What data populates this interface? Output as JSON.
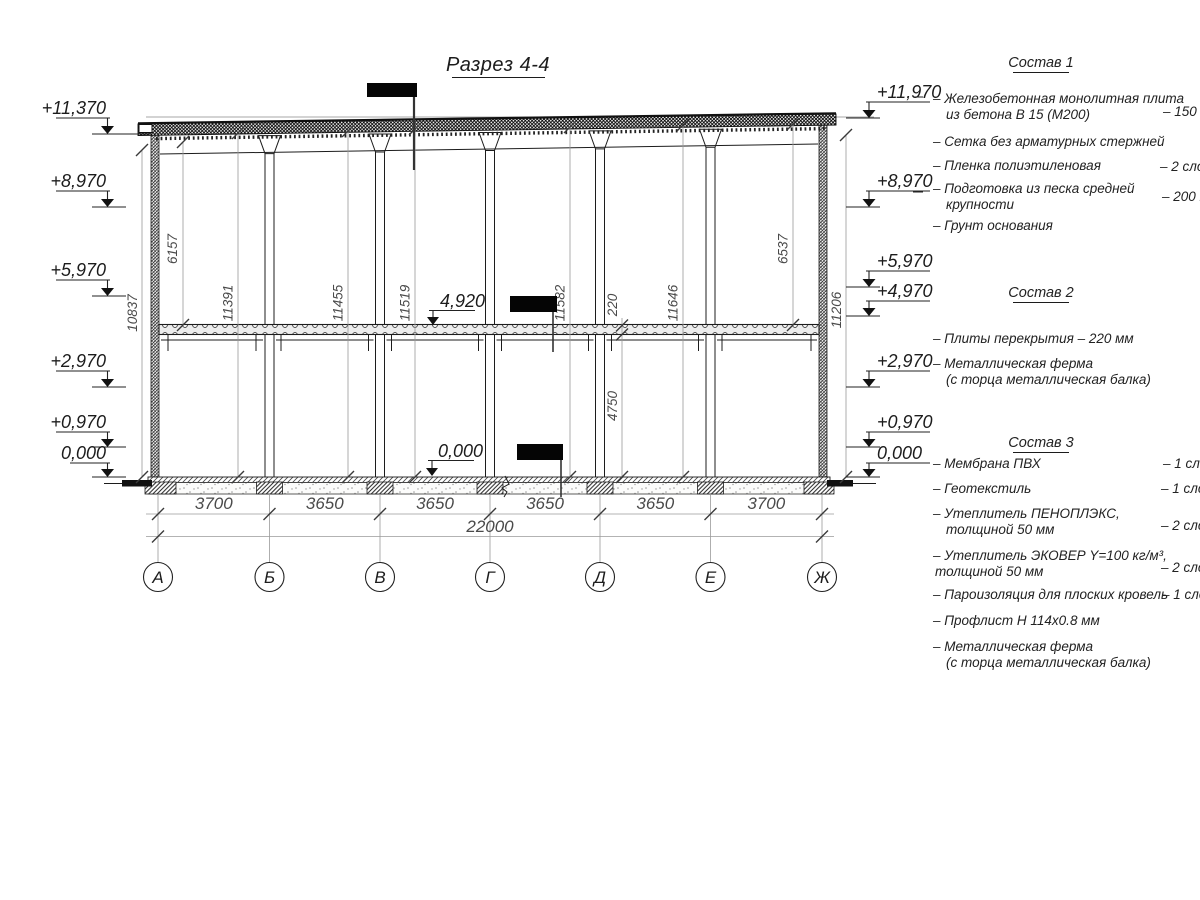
{
  "title": "Разрез 4-4",
  "axes": {
    "labels": [
      "А",
      "Б",
      "В",
      "Г",
      "Д",
      "Е",
      "Ж"
    ]
  },
  "dimensions": {
    "spans": [
      "3700",
      "3650",
      "3650",
      "3650",
      "3650",
      "3700"
    ],
    "total": "22000",
    "vertical": {
      "outer_left": "10837",
      "upper_left": "6157",
      "h1": "11391",
      "h2": "11455",
      "h3": "11519",
      "h4": "11582",
      "slab_thickness": "220",
      "h5": "11646",
      "lower_mid": "4750",
      "upper_right": "6537",
      "outer_right": "11206"
    }
  },
  "elevation_marks": {
    "left": [
      "+11,370",
      "+8,970",
      "+5,970",
      "+2,970",
      "+0,970",
      "0,000"
    ],
    "right": [
      "+11,970",
      "+8,970",
      "+5,970",
      "+4,970",
      "+2,970",
      "+0,970",
      "0,000"
    ],
    "inner": [
      "4,920",
      "0,000"
    ]
  },
  "notes": {
    "sostav1": {
      "title": "Состав 1",
      "items": [
        {
          "line1": "– Железобетонная  монолитная плита",
          "line2": "из бетона В 15 (М200)",
          "qty": "– 150 мм"
        },
        {
          "line1": "– Сетка без арматурных стержней",
          "line2": "",
          "qty": ""
        },
        {
          "line1": "– Пленка полиэтиленовая",
          "line2": "",
          "qty": "– 2 слоя"
        },
        {
          "line1": "– Подготовка из песка средней",
          "line2": "крупности",
          "qty": "– 200 мм"
        },
        {
          "line1": "– Грунт основания",
          "line2": "",
          "qty": ""
        }
      ]
    },
    "sostav2": {
      "title": "Состав 2",
      "items": [
        {
          "line1": "– Плиты перекрытия – 220 мм",
          "line2": "",
          "qty": ""
        },
        {
          "line1": "– Металлическая ферма",
          "line2": "(с торца металлическая балка)",
          "qty": ""
        }
      ]
    },
    "sostav3": {
      "title": "Состав 3",
      "items": [
        {
          "line1": "– Мембрана ПВХ",
          "line2": "",
          "qty": "– 1 слой"
        },
        {
          "line1": "– Геотекстиль",
          "line2": "",
          "qty": "– 1 слой"
        },
        {
          "line1": "– Утеплитель ПЕНОПЛЭКС,",
          "line2": "толщиной 50 мм",
          "qty": "– 2 слоя"
        },
        {
          "line1": "– Утеплитель ЭКОВЕР Y=100 кг/м³,",
          "line2": "толщиной 50 мм",
          "qty": "– 2 слоя"
        },
        {
          "line1": "– Пароизоляция для плоских кровель",
          "line2": "",
          "qty": "– 1 слой"
        },
        {
          "line1": "– Профлист Н 114х0.8 мм",
          "line2": "",
          "qty": ""
        },
        {
          "line1": "– Металлическая ферма",
          "line2": "(с торца металлическая балка)",
          "qty": ""
        }
      ]
    }
  }
}
